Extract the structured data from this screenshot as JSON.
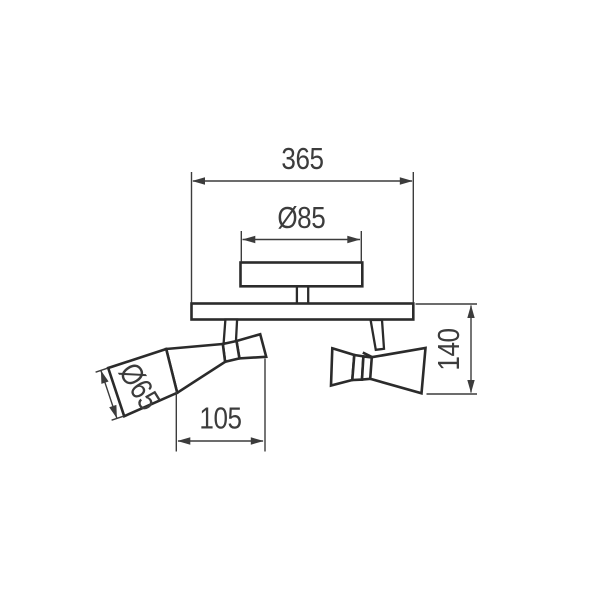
{
  "drawing": {
    "type": "technical-dimension-drawing",
    "subject": "twin-head ceiling spotlight side view",
    "background_color": "#ffffff",
    "outline_color": "#2b2b2b",
    "dimension_color": "#3c3c3c",
    "dimensions": {
      "total_width": {
        "label": "365"
      },
      "canopy_diameter": {
        "label": "Ø85"
      },
      "fixture_height": {
        "label": "140"
      },
      "head_length": {
        "label": "105"
      },
      "head_diameter": {
        "label": "Ø65"
      }
    }
  }
}
